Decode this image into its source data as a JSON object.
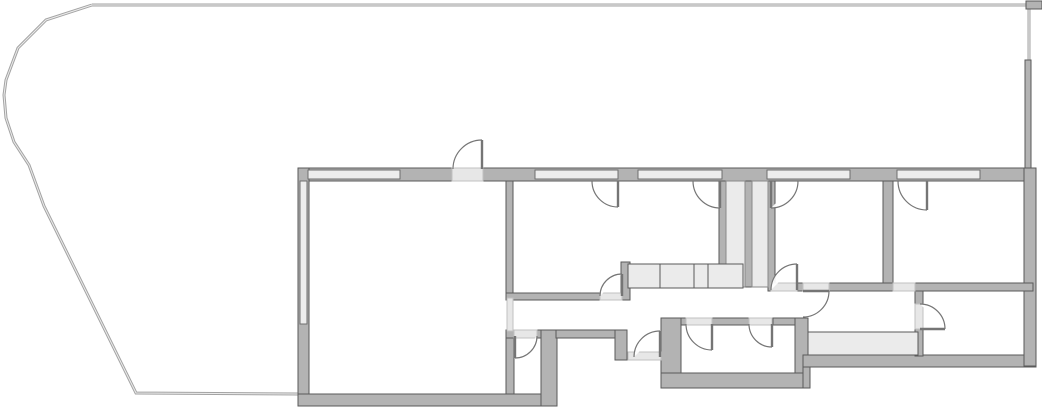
{
  "meta": {
    "kind": "architectural-floor-plan",
    "visible_text": "none"
  },
  "canvas": {
    "width": 1042,
    "height": 416,
    "background": "#ffffff"
  },
  "palette": {
    "wall_fill": "#b3b3b3",
    "wall_stroke": "#5a5a5a",
    "window_fill": "#ededed",
    "window_stroke": "#6e6e6e",
    "threshold_fill": "#e7e7e7",
    "shaft_fill": "#ebebeb",
    "shaft_stroke": "#8a8a8a",
    "cabinet_fill": "#ebebeb",
    "cabinet_stroke": "#5a5a5a",
    "door_stroke": "#757575",
    "boundary_stroke": "#a3a3a3",
    "boundary_highlight": "#ececec"
  },
  "floorplan": {
    "boundary": {
      "curve_points": [
        [
          92,
          5
        ],
        [
          46,
          20
        ],
        [
          18,
          48
        ],
        [
          6,
          80
        ],
        [
          4,
          95
        ],
        [
          6,
          118
        ],
        [
          14,
          142
        ],
        [
          29,
          165
        ],
        [
          44,
          206
        ],
        [
          136,
          393
        ],
        [
          298,
          394
        ]
      ],
      "top_line": [
        [
          92,
          5
        ],
        [
          1026,
          5
        ]
      ],
      "right_thin_line": [
        [
          1029,
          5
        ],
        [
          1029,
          60
        ]
      ],
      "corner_block": [
        1026,
        1,
        16,
        8
      ]
    },
    "walls": [
      [
        298,
        168,
        735,
        13
      ],
      [
        298,
        168,
        11,
        238
      ],
      [
        298,
        394,
        259,
        12
      ],
      [
        506,
        181,
        7,
        117
      ],
      [
        506,
        330,
        8,
        64
      ],
      [
        506,
        330,
        9,
        8
      ],
      [
        537,
        330,
        19,
        8
      ],
      [
        541,
        330,
        16,
        76
      ],
      [
        556,
        330,
        61,
        8
      ],
      [
        615,
        330,
        12,
        30
      ],
      [
        506,
        293,
        94,
        7
      ],
      [
        621,
        262,
        9,
        38
      ],
      [
        719,
        181,
        7,
        106
      ],
      [
        745,
        181,
        7,
        106
      ],
      [
        768,
        181,
        7,
        110
      ],
      [
        797,
        283,
        6,
        8
      ],
      [
        829,
        283,
        64,
        8
      ],
      [
        883,
        181,
        10,
        102
      ],
      [
        661,
        318,
        20,
        70
      ],
      [
        681,
        318,
        5,
        7
      ],
      [
        712,
        318,
        37,
        7
      ],
      [
        773,
        318,
        22,
        7
      ],
      [
        795,
        318,
        13,
        55
      ],
      [
        661,
        373,
        147,
        15
      ],
      [
        803,
        365,
        7,
        23
      ],
      [
        803,
        355,
        233,
        12
      ],
      [
        1024,
        168,
        12,
        198
      ],
      [
        1025,
        60,
        6,
        108
      ],
      [
        915,
        283,
        118,
        8
      ],
      [
        915,
        291,
        8,
        13
      ],
      [
        915,
        329,
        8,
        27
      ]
    ],
    "windows": [
      [
        308,
        170,
        92,
        9
      ],
      [
        535,
        170,
        83,
        9
      ],
      [
        638,
        170,
        84,
        9
      ],
      [
        767,
        170,
        83,
        9
      ],
      [
        897,
        170,
        83,
        9
      ],
      [
        300,
        181,
        7,
        143
      ]
    ],
    "thresholds": [
      [
        452,
        168,
        31,
        13
      ],
      [
        507,
        298,
        6,
        33
      ],
      [
        600,
        293,
        22,
        7
      ],
      [
        771,
        283,
        26,
        8
      ],
      [
        803,
        283,
        26,
        8
      ],
      [
        514,
        330,
        23,
        8
      ],
      [
        686,
        318,
        26,
        7
      ],
      [
        749,
        318,
        23,
        7
      ],
      [
        628,
        352,
        33,
        8
      ],
      [
        915,
        304,
        8,
        25
      ],
      [
        893,
        283,
        22,
        8
      ]
    ],
    "shafts": [
      [
        726,
        181,
        19,
        106
      ],
      [
        752,
        181,
        16,
        106
      ]
    ],
    "cabinets": [
      {
        "rect": [
          628,
          264,
          115,
          24
        ],
        "dividers_x": [
          660,
          694,
          708
        ]
      },
      {
        "rect": [
          808,
          332,
          110,
          23
        ],
        "dividers_x": []
      }
    ],
    "doors": [
      {
        "name": "terrace-door-swing-out",
        "hinge": [
          482,
          169
        ],
        "r": 29,
        "jamb_angle": 180,
        "leaf_angle": 270
      },
      {
        "name": "room-a-terrace-door",
        "hinge": [
          618,
          181
        ],
        "r": 26,
        "jamb_angle": 180,
        "leaf_angle": 90
      },
      {
        "name": "kitchen-terrace-door",
        "hinge": [
          720,
          181
        ],
        "r": 27,
        "jamb_angle": 180,
        "leaf_angle": 90
      },
      {
        "name": "room-b-terrace-door",
        "hinge": [
          771,
          181
        ],
        "r": 27,
        "jamb_angle": 0,
        "leaf_angle": 90
      },
      {
        "name": "room-c-terrace-door",
        "hinge": [
          927,
          181
        ],
        "r": 29,
        "jamb_angle": 180,
        "leaf_angle": 90
      },
      {
        "name": "room-a-hall-door",
        "hinge": [
          622,
          296
        ],
        "r": 22,
        "jamb_angle": 180,
        "leaf_angle": 270
      },
      {
        "name": "room-b-hall-door",
        "hinge": [
          797,
          290
        ],
        "r": 26,
        "jamb_angle": 180,
        "leaf_angle": 270
      },
      {
        "name": "hall-corridor-door",
        "hinge": [
          803,
          291
        ],
        "r": 26,
        "jamb_angle": 90,
        "leaf_angle": 0
      },
      {
        "name": "wc-door",
        "hinge": [
          515,
          336
        ],
        "r": 22,
        "jamb_angle": 0,
        "leaf_angle": 90
      },
      {
        "name": "bathroom-door-left",
        "hinge": [
          712,
          324
        ],
        "r": 26,
        "jamb_angle": 180,
        "leaf_angle": 90
      },
      {
        "name": "bathroom-door-right",
        "hinge": [
          772,
          324
        ],
        "r": 23,
        "jamb_angle": 180,
        "leaf_angle": 90
      },
      {
        "name": "entrance-door",
        "hinge": [
          660,
          357
        ],
        "r": 26,
        "jamb_angle": 180,
        "leaf_angle": 270
      },
      {
        "name": "bottom-right-room-door",
        "hinge": [
          920,
          329
        ],
        "r": 25,
        "jamb_angle": 270,
        "leaf_angle": 0
      }
    ]
  }
}
